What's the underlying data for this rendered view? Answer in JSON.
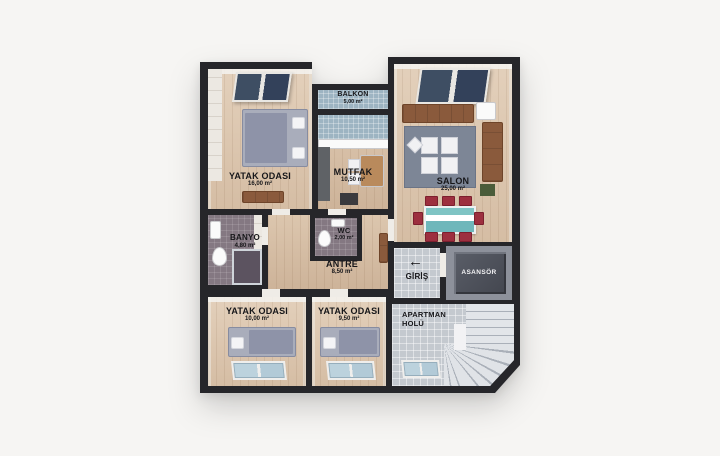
{
  "image": {
    "background": "#f6f5f3",
    "type": "3d-floor-plan"
  },
  "colors": {
    "wall": "#26262a",
    "wood_floor": "#d8c2ab",
    "blue_tile": "#9db4c2",
    "gray_tile": "#c4c9cf",
    "bath_tile": "#847882",
    "elevator_shaft": "#4b4e57",
    "sofa_brown": "#8a5a3c",
    "chair_red": "#9d2f3f",
    "carpet_gray": "#7d8696",
    "skylight_glass": "#3e4e63",
    "window_glass": "#bcd2dd"
  },
  "rooms": {
    "bedroom_top": {
      "name": "YATAK ODASI",
      "area": "16,00 m²"
    },
    "balcony": {
      "name": "BALKON",
      "area": "5,00 m²"
    },
    "kitchen": {
      "name": "MUTFAK",
      "area": "10,50 m²"
    },
    "living_room": {
      "name": "SALON",
      "area": "25,00 m²"
    },
    "bathroom": {
      "name": "BANYO",
      "area": "4,80 m²"
    },
    "wc": {
      "name": "WC",
      "area": "2,00 m²"
    },
    "entrance_hall": {
      "name": "ANTRE",
      "area": "8,50 m²"
    },
    "entrance": {
      "name": "GİRİŞ",
      "arrow": "←"
    },
    "elevator": {
      "name": "ASANSÖR"
    },
    "bedroom_bottom_left": {
      "name": "YATAK ODASI",
      "area": "10,00 m²"
    },
    "bedroom_bottom_mid": {
      "name": "YATAK ODASI",
      "area": "9,50 m²"
    },
    "stair_hall": {
      "name_line1": "APARTMAN",
      "name_line2": "HOLÜ"
    }
  }
}
